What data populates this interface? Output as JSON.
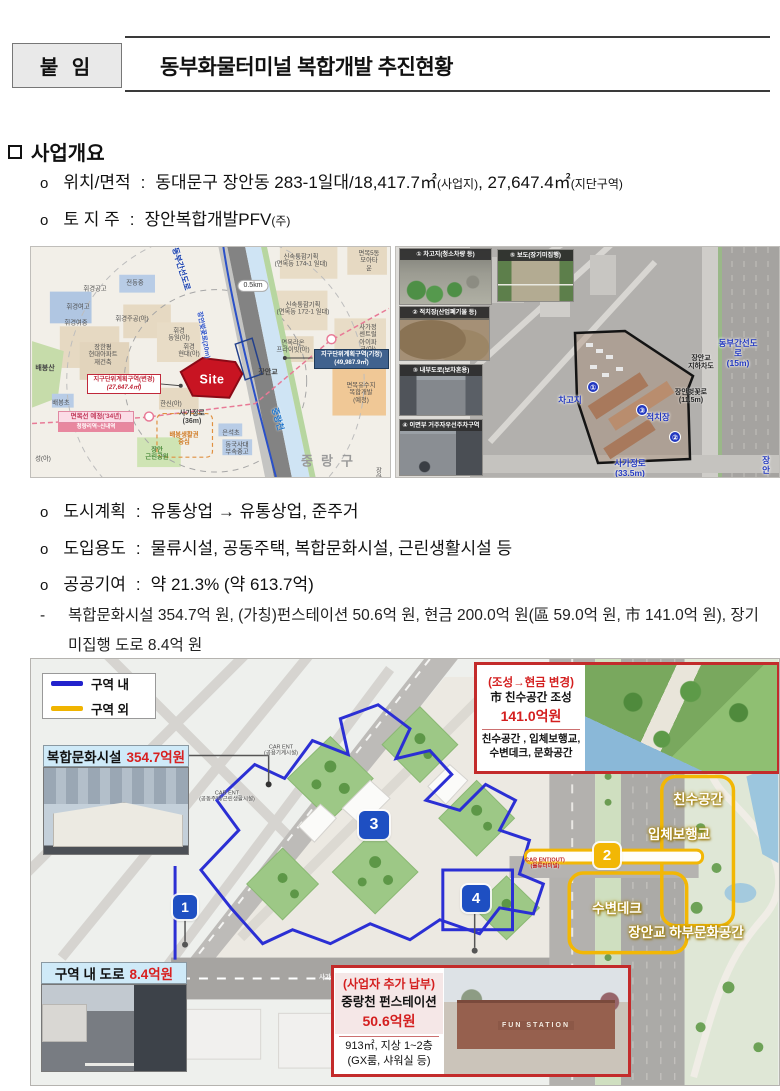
{
  "header": {
    "attachment_label": "붙 임",
    "title": "동부화물터미널 복합개발 추진현황"
  },
  "overview": {
    "section_title": "사업개요",
    "marker": "o",
    "colon": ":",
    "sub_dash": "-",
    "items": [
      {
        "label": "위치/면적",
        "main1": "동대문구 장안동 283-1일대/18,417.7㎡",
        "small1": "(사업지)",
        "main2": ", 27,647.4㎡",
        "small2": "(지단구역)"
      },
      {
        "label": "토 지 주",
        "main1": "장안복합개발PFV",
        "small1": "(주)",
        "main2": "",
        "small2": ""
      },
      {
        "label": "도시계획",
        "main1": "유통상업 → 유통상업, 준주거",
        "small1": "",
        "main2": "",
        "small2": ""
      },
      {
        "label": "도입용도",
        "main1": "물류시설, 공동주택, 복합문화시설, 근린생활시설 등",
        "small1": "",
        "main2": "",
        "small2": ""
      },
      {
        "label": "공공기여",
        "main1": "약 21.3% (약 613.7억)",
        "small1": "",
        "main2": "",
        "small2": ""
      }
    ],
    "sub_text": "복합문화시설 354.7억 원, (가칭)펀스테이션 50.6억 원, 현금 200.0억 원(區 59.0억 원, 市 141.0억 원), 장기미집행 도로 8.4억 원"
  },
  "map": {
    "boxes": {
      "district_change": {
        "line1": "지구단위계획구역(변경)",
        "line2": "(27,647.4㎡)"
      },
      "district_existing": {
        "line1": "지구단위계획구역(기정)",
        "line2": "(49,987.9㎡)"
      },
      "myeongmok": {
        "line1": "면목선 예정('34년)",
        "line2": "청량리역~신내역"
      }
    },
    "labels": [
      {
        "t": "동부간선도로",
        "x": 150,
        "y": 22,
        "cls": "roadblue",
        "rot": 73
      },
      {
        "t": "장안벚꽃로(20m)",
        "x": 172,
        "y": 88,
        "cls": "roadsmall",
        "rot": 80
      },
      {
        "t": "0.5km",
        "x": 222,
        "y": 39,
        "cls": "pill"
      },
      {
        "t": "신속통합기획\n(면목동 174-1 일대)",
        "x": 270,
        "y": 14,
        "cls": "m"
      },
      {
        "t": "면목5동\n모아타운",
        "x": 338,
        "y": 14,
        "cls": "m"
      },
      {
        "t": "신속통합기획\n(면목동 172-1 일대)",
        "x": 272,
        "y": 62,
        "cls": "m"
      },
      {
        "t": "면목라온\n프라이빗(아)",
        "x": 262,
        "y": 100,
        "cls": "m"
      },
      {
        "t": "사가정 센트럴\n아이파크(아)",
        "x": 337,
        "y": 92,
        "cls": "m"
      },
      {
        "t": "면목유수지\n복합개발\n(예정)",
        "x": 330,
        "y": 146,
        "cls": "m"
      },
      {
        "t": "장안교",
        "x": 237,
        "y": 126,
        "cls": "mb"
      },
      {
        "t": "중랑천",
        "x": 247,
        "y": 172,
        "cls": "water",
        "rot": 74
      },
      {
        "t": "중랑구",
        "x": 300,
        "y": 214,
        "cls": "biggray"
      },
      {
        "t": "배봉산",
        "x": 14,
        "y": 122,
        "cls": "mb"
      },
      {
        "t": "배봉초",
        "x": 30,
        "y": 156,
        "cls": "m"
      },
      {
        "t": "휘경여고",
        "x": 47,
        "y": 60,
        "cls": "m"
      },
      {
        "t": "휘경여중",
        "x": 45,
        "y": 76,
        "cls": "m"
      },
      {
        "t": "전동중",
        "x": 104,
        "y": 36,
        "cls": "m"
      },
      {
        "t": "휘경공고",
        "x": 64,
        "y": 42,
        "cls": "m"
      },
      {
        "t": "휘경주공(아)",
        "x": 101,
        "y": 72,
        "cls": "m"
      },
      {
        "t": "휘경\n동일(아)",
        "x": 148,
        "y": 88,
        "cls": "m"
      },
      {
        "t": "휘경\n현대(아)",
        "x": 158,
        "y": 104,
        "cls": "m"
      },
      {
        "t": "장한평\n현대아파트\n재건축",
        "x": 72,
        "y": 108,
        "cls": "m"
      },
      {
        "t": "한신(아)",
        "x": 140,
        "y": 157,
        "cls": "m"
      },
      {
        "t": "사가정로\n(36m)",
        "x": 161,
        "y": 171,
        "cls": "mb"
      },
      {
        "t": "은석초",
        "x": 200,
        "y": 186,
        "cls": "m"
      },
      {
        "t": "동국사대\n부속중고",
        "x": 206,
        "y": 202,
        "cls": "m"
      },
      {
        "t": "배봉생활권\n중심",
        "x": 153,
        "y": 192,
        "cls": "orange"
      },
      {
        "t": "장안\n근린공원",
        "x": 126,
        "y": 207,
        "cls": "green"
      },
      {
        "t": "성(아)",
        "x": 12,
        "y": 212,
        "cls": "m"
      },
      {
        "t": "장안",
        "x": 348,
        "y": 228,
        "cls": "m"
      },
      {
        "t": "Site",
        "x": 181,
        "y": 133,
        "cls": "sitetxt"
      }
    ]
  },
  "photos": {
    "items": [
      {
        "caption": "① 차고지(청소차량 등)"
      },
      {
        "caption": "② 적치장(산업폐기물 등)"
      },
      {
        "caption": "③ 내부도로(보차혼용)"
      },
      {
        "caption": "④ 이면부 거주자우선주차구역"
      },
      {
        "caption": "⑤ 보도(장기미집행)"
      }
    ]
  },
  "aerial": {
    "labels": [
      {
        "t": "①",
        "x": 123,
        "y": 140,
        "cls": "abadge"
      },
      {
        "t": "차고지",
        "x": 100,
        "y": 153,
        "cls": "ablue"
      },
      {
        "t": "②",
        "x": 205,
        "y": 190,
        "cls": "abadge"
      },
      {
        "t": "적치장",
        "x": 188,
        "y": 170,
        "cls": "ablue"
      },
      {
        "t": "③",
        "x": 172,
        "y": 163,
        "cls": "abadge"
      },
      {
        "t": "사가정로\n(33.5m)",
        "x": 160,
        "y": 221,
        "cls": "ablue"
      },
      {
        "t": "동부간선도로\n(15m)",
        "x": 268,
        "y": 106,
        "cls": "ablue"
      },
      {
        "t": "장안교\n지하차도",
        "x": 231,
        "y": 116,
        "cls": "adark"
      },
      {
        "t": "장안벚꽃로\n(11.5m)",
        "x": 221,
        "y": 150,
        "cls": "adark"
      },
      {
        "t": "장안",
        "x": 296,
        "y": 218,
        "cls": "ablue"
      }
    ]
  },
  "plan": {
    "legend": {
      "in_label": "구역 내",
      "out_label": "구역 외",
      "in_color": "#2222cc",
      "out_color": "#f0b400"
    },
    "culture_callout": {
      "name": "복합문화시설",
      "amount": "354.7억원"
    },
    "road_callout": {
      "name": "구역 내 도로",
      "amount": "8.4억원"
    },
    "redbox_river": {
      "title": "(조성→현금 변경)",
      "subtitle": "市 친수공간 조성",
      "amount": "141.0억원",
      "desc1": "친수공간 , 입체보행교,",
      "desc2": "수변데크, 문화공간"
    },
    "redbox_fun": {
      "title": "(사업자 추가 납부)",
      "subtitle": "중랑천 펀스테이션",
      "amount": "50.6억원",
      "desc1": "913㎡, 지상 1~2층",
      "desc2": "(GX룸, 샤워실 등)",
      "sign": "FUN STATION"
    },
    "badges": {
      "b1": "1",
      "b2": "2",
      "b3": "3",
      "b4": "4"
    },
    "labels": [
      {
        "t": "CAR ENT\n(공용기계시설)",
        "x": 250,
        "y": 92,
        "cls": "tiny"
      },
      {
        "t": "CAR ENT\n(공동주택/근린생활시설)",
        "x": 196,
        "y": 138,
        "cls": "tiny"
      },
      {
        "t": "CAR ENT(OUT)\n(물류터미널)",
        "x": 514,
        "y": 205,
        "cls": "tinyred"
      },
      {
        "t": "사가정로",
        "x": 300,
        "y": 319,
        "cls": "tinywhite"
      },
      {
        "t": "친수공간",
        "x": 667,
        "y": 141,
        "cls": "ylabel"
      },
      {
        "t": "입체보행교",
        "x": 648,
        "y": 176,
        "cls": "ylabel"
      },
      {
        "t": "수변데크",
        "x": 586,
        "y": 250,
        "cls": "ylabel"
      },
      {
        "t": "장안교 하부문화공간",
        "x": 655,
        "y": 274,
        "cls": "ylabel"
      }
    ]
  }
}
